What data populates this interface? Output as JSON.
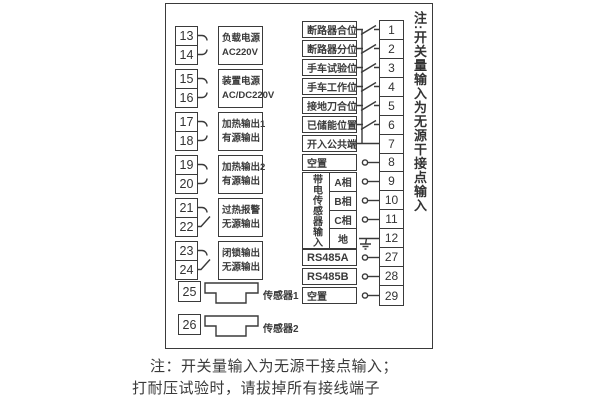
{
  "left_groups": [
    {
      "terminals": [
        "13",
        "14"
      ],
      "label_lines": [
        "负载电源",
        "AC220V"
      ]
    },
    {
      "terminals": [
        "15",
        "16"
      ],
      "label_lines": [
        "装置电源",
        "AC/DC220V"
      ]
    },
    {
      "terminals": [
        "17",
        "18"
      ],
      "label_lines": [
        "加热输出1",
        "有源输出"
      ]
    },
    {
      "terminals": [
        "19",
        "20"
      ],
      "label_lines": [
        "加热输出2",
        "有源输出"
      ]
    },
    {
      "terminals": [
        "21",
        "22"
      ],
      "label_lines": [
        "过热报警",
        "无源输出"
      ]
    },
    {
      "terminals": [
        "23",
        "24"
      ],
      "label_lines": [
        "闭锁输出",
        "无源输出"
      ]
    }
  ],
  "sensors": [
    {
      "terminal": "25",
      "label": "传感器1"
    },
    {
      "terminal": "26",
      "label": "传感器2"
    }
  ],
  "digital_inputs": [
    {
      "terminal": "1",
      "label": "断路器合位"
    },
    {
      "terminal": "2",
      "label": "断路器分位"
    },
    {
      "terminal": "3",
      "label": "手车试验位"
    },
    {
      "terminal": "4",
      "label": "手车工作位"
    },
    {
      "terminal": "5",
      "label": "接地刀合位"
    },
    {
      "terminal": "6",
      "label": "已储能位置"
    },
    {
      "terminal": "7",
      "label": "开入公共端"
    },
    {
      "terminal": "8",
      "label": "空置"
    }
  ],
  "live_sensor_group": {
    "vertical_label": "带电传感器输入",
    "channels": [
      {
        "terminal": "9",
        "label": "A相"
      },
      {
        "terminal": "10",
        "label": "B相"
      },
      {
        "terminal": "11",
        "label": "C相"
      },
      {
        "terminal": "12",
        "label": "地"
      }
    ]
  },
  "comm_rows": [
    {
      "terminal": "27",
      "label": "RS485A"
    },
    {
      "terminal": "28",
      "label": "RS485B"
    },
    {
      "terminal": "29",
      "label": "空置"
    }
  ],
  "side_note": "注:开关量输入为无源干接点输入",
  "footer_notes": [
    "注：开关量输入为无源干接点输入；",
    "打耐压试验时，请拔掉所有接线端子"
  ],
  "colors": {
    "line": "#3a3a3a",
    "background": "#ffffff"
  }
}
